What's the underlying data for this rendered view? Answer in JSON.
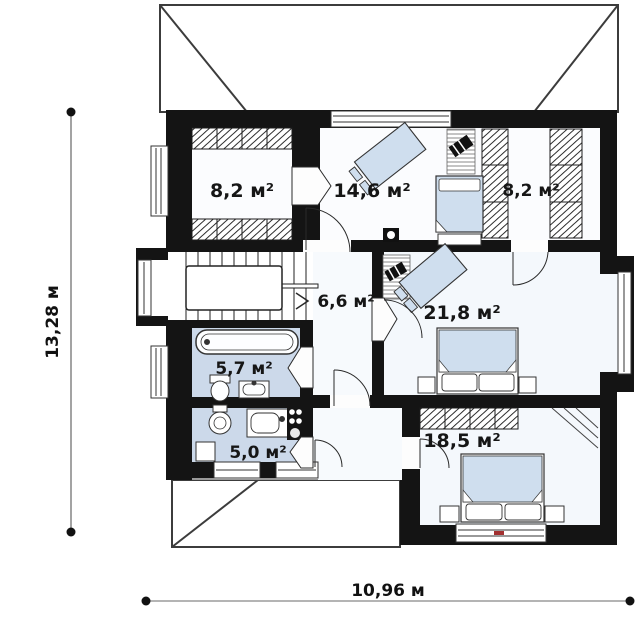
{
  "plan": {
    "rooms": [
      {
        "name": "wardrobe-left",
        "label": "8,2 м²"
      },
      {
        "name": "bedroom-top",
        "label": "14,6 м²"
      },
      {
        "name": "wardrobe-right",
        "label": "8,2 м²"
      },
      {
        "name": "hall",
        "label": "6,6 м²"
      },
      {
        "name": "bedroom-right",
        "label": "21,8 м²"
      },
      {
        "name": "bathroom",
        "label": "5,7 м²"
      },
      {
        "name": "kitchen",
        "label": "5,0 м²"
      },
      {
        "name": "bedroom-bottom",
        "label": "18,5 м²"
      }
    ],
    "dimensions": {
      "height": "13,28 м",
      "width": "10,96 м"
    },
    "colors": {
      "wall": "#141414",
      "wet_floor": "#ccd9ea",
      "furniture": "#cfdeee",
      "room_floor": "#f4f8fc"
    }
  }
}
